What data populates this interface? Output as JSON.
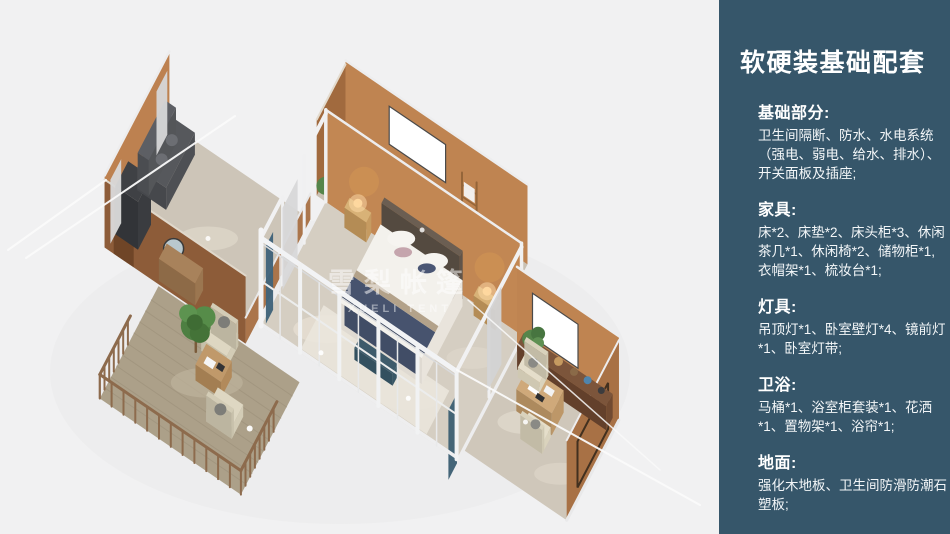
{
  "page": {
    "background_color": "#f1f1f2"
  },
  "panel": {
    "title": "软硬装基础配套",
    "bg_color": "#36566a",
    "text_color": "#ffffff",
    "sections": [
      {
        "heading": "基础部分:",
        "body": "卫生间隔断、防水、水电系统（强电、弱电、给水、排水）、开关面板及插座;"
      },
      {
        "heading": "家具:",
        "body": "床*2、床垫*2、床头柜*3、休闲茶几*1、休闲椅*2、储物柜*1, 衣帽架*1、梳妆台*1;"
      },
      {
        "heading": "灯具:",
        "body": "吊顶灯*1、卧室壁灯*4、镜前灯*1、卧室灯带;"
      },
      {
        "heading": "卫浴:",
        "body": "马桶*1、浴室柜套装*1、花洒*1、置物架*1、浴帘*1;"
      },
      {
        "heading": "地面:",
        "body": "强化木地板、卫生间防滑防潮石塑板;"
      }
    ]
  },
  "illustration": {
    "watermark_cn": "雪梨帐篷",
    "watermark_en": "XUELI TENT"
  }
}
